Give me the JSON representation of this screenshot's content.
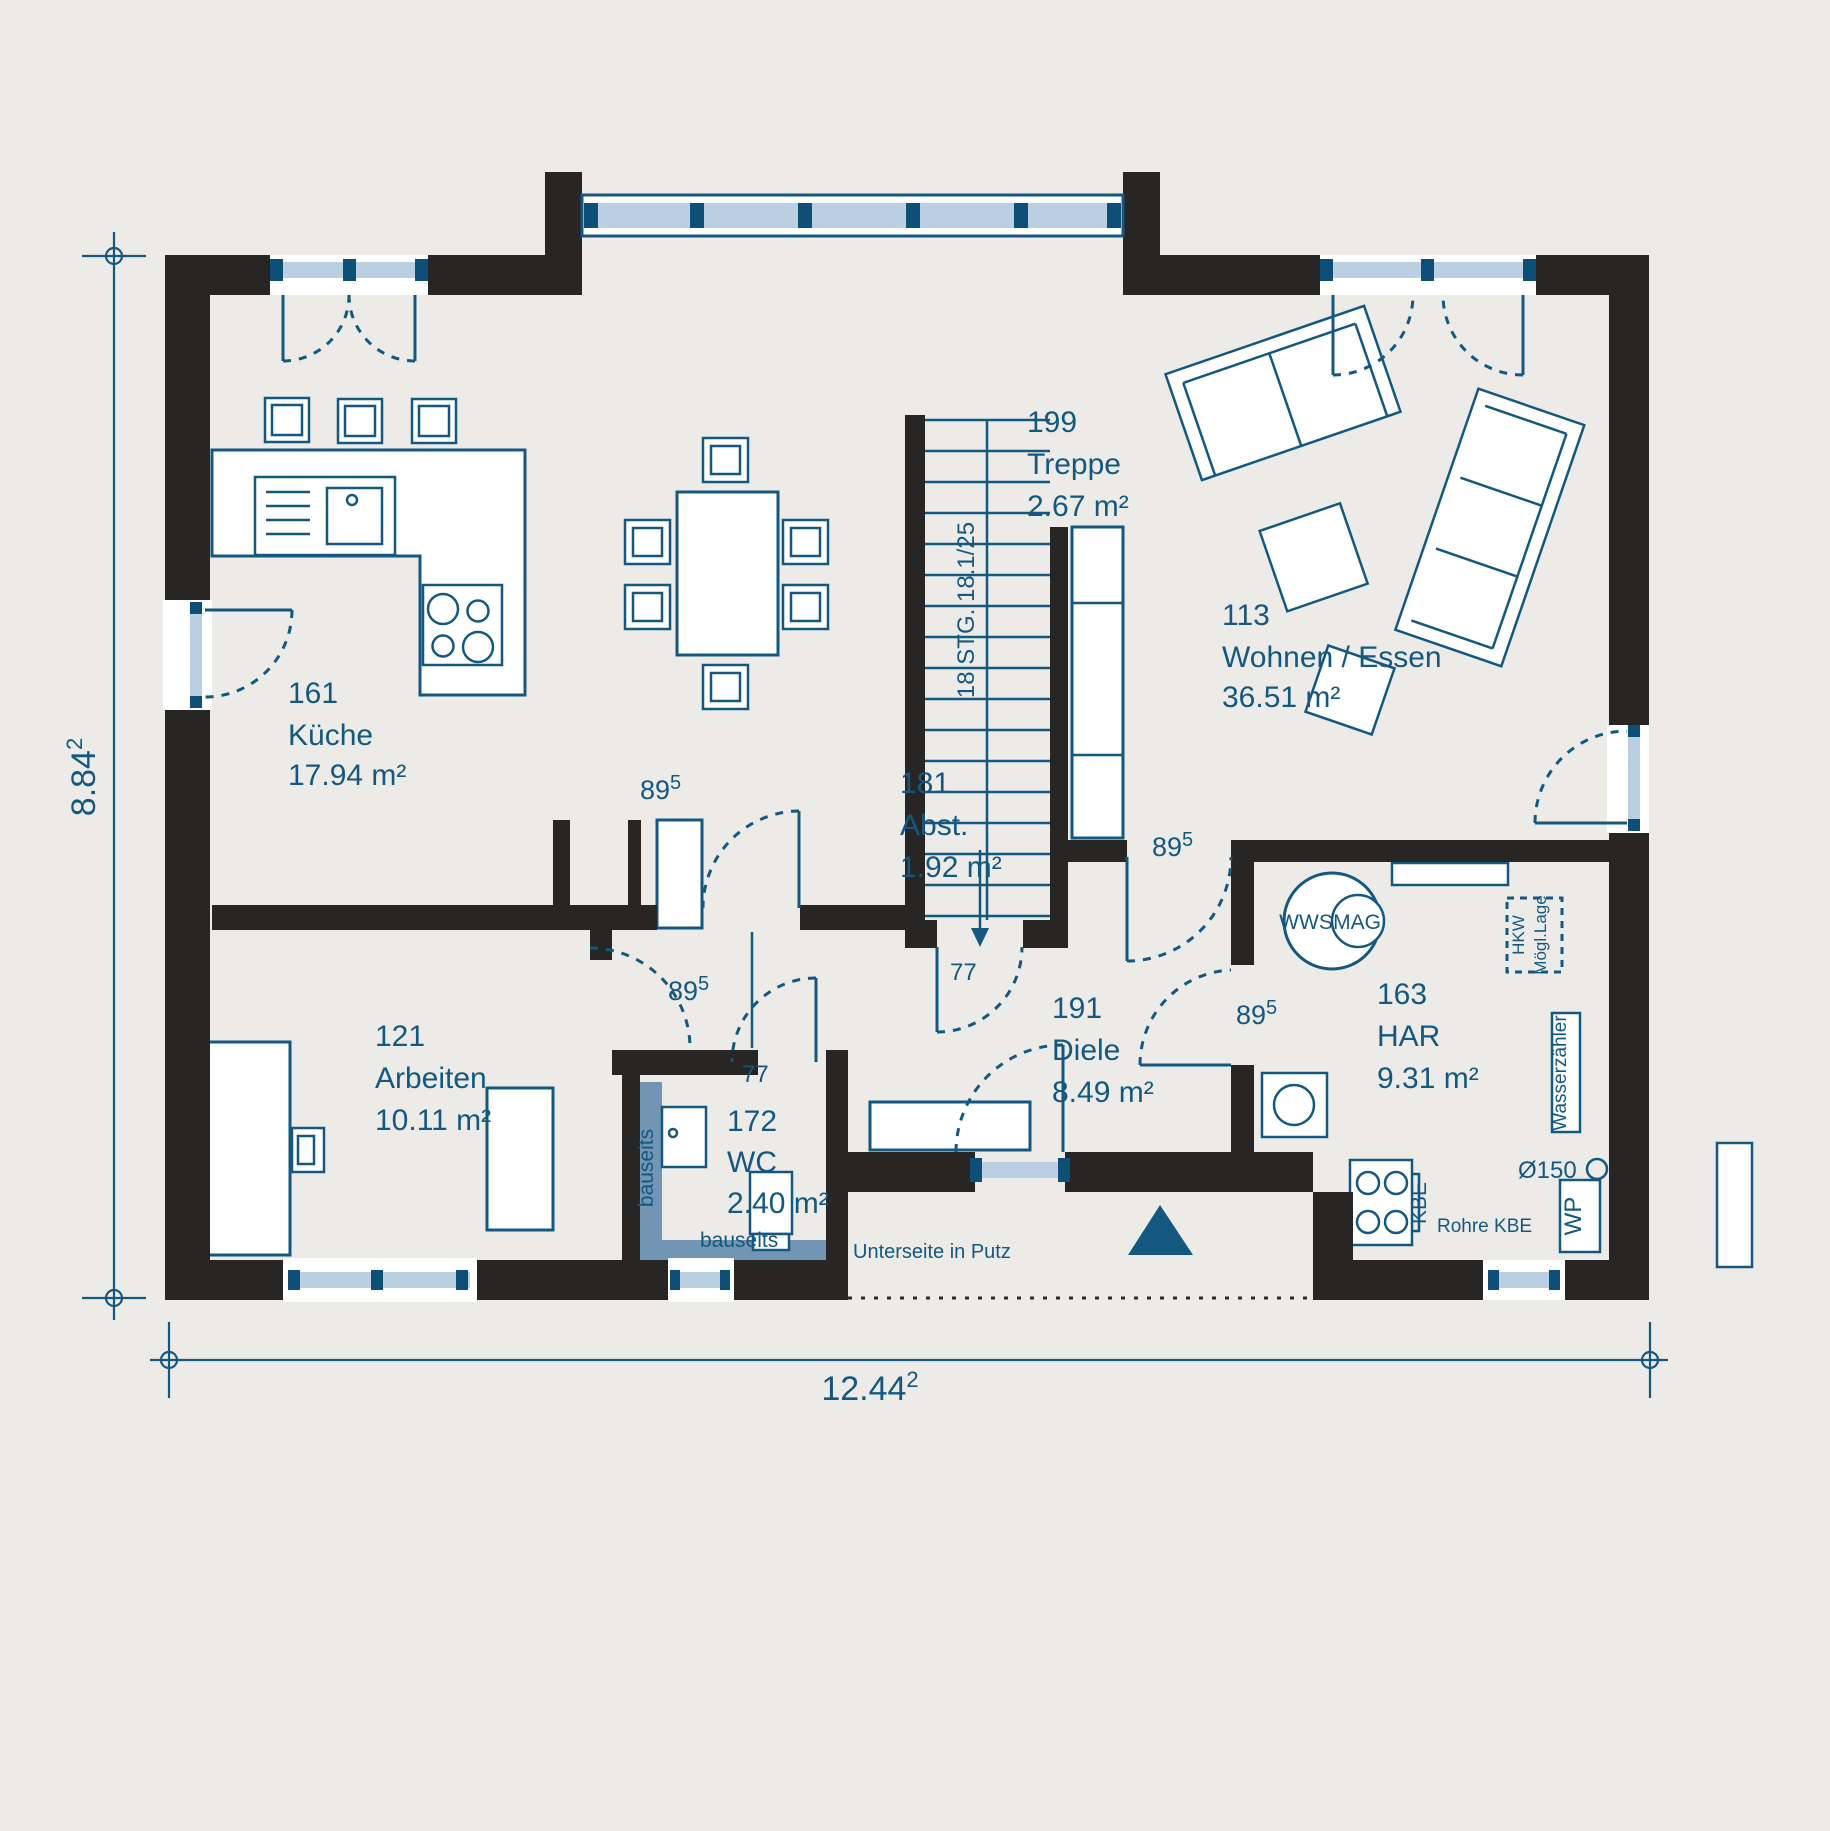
{
  "meta": {
    "colors": {
      "background": "#edebe8",
      "wall": "#272625",
      "line_blue": "#14587f",
      "window_glass": "#bacfe2",
      "window_mullion": "#0e4f78",
      "bauseits_fill": "#7195b3"
    }
  },
  "rooms": [
    {
      "id": "161",
      "name": "Küche",
      "area": "17.94 m²"
    },
    {
      "id": "121",
      "name": "Arbeiten",
      "area": "10.11 m²"
    },
    {
      "id": "172",
      "name": "WC",
      "area": "2.40 m²"
    },
    {
      "id": "199",
      "name": "Treppe",
      "area": "2.67 m²"
    },
    {
      "id": "181",
      "name": "Abst.",
      "area": "1.92 m²"
    },
    {
      "id": "191",
      "name": "Diele",
      "area": "8.49 m²"
    },
    {
      "id": "113",
      "name": "Wohnen / Essen",
      "area": "36.51 m²"
    },
    {
      "id": "163",
      "name": "HAR",
      "area": "9.31 m²"
    }
  ],
  "dims": {
    "width": {
      "value": "12.44",
      "sup": "2"
    },
    "height": {
      "value": "8.84",
      "sup": "2"
    },
    "door": {
      "value": "89",
      "sup": "5"
    },
    "narrow": "77"
  },
  "stair": {
    "label": "18 STG. 18.1/25"
  },
  "labels": {
    "unterseite": "Unterseite in Putz",
    "bauseits": "bauseits",
    "wws": "WWS",
    "mag": "MAG",
    "hkw1": "HKW",
    "hkw2": "Mögl.Lage",
    "wasserzaehler": "Wasserzähler",
    "kbe": "KBE",
    "rohre_kbe": "Rohre KBE",
    "diameter": "Ø150",
    "wp": "WP"
  }
}
